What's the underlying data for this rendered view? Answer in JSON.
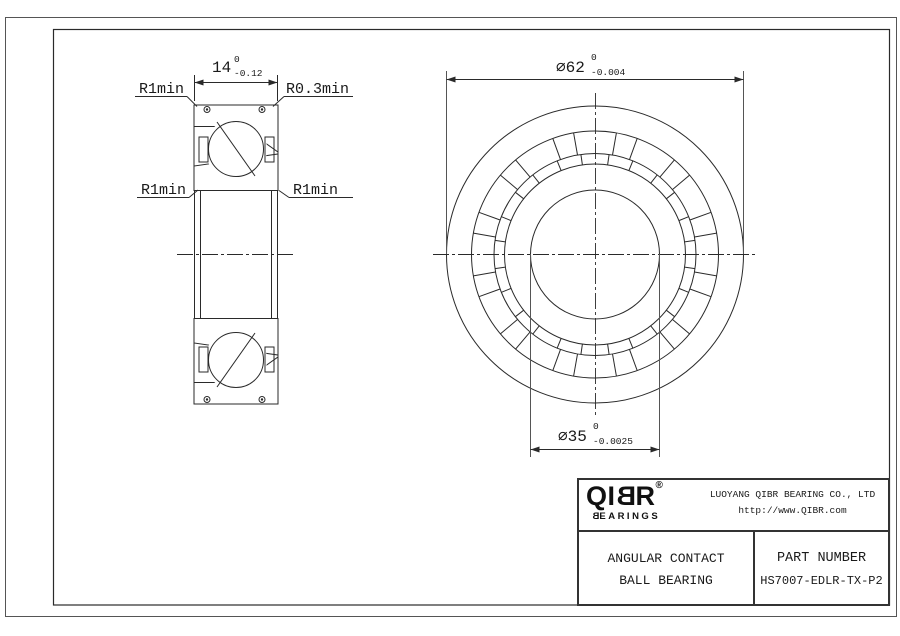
{
  "section_view": {
    "width_dim": {
      "value": "14",
      "tol_top": "0",
      "tol_bottom": "-0.12"
    },
    "label_top_left": "R1min",
    "label_top_right": "R0.3min",
    "label_mid_left": "R1min",
    "label_mid_right": "R1min"
  },
  "front_view": {
    "od_dim": {
      "value": "⌀62",
      "tol_top": "0",
      "tol_bottom": "-0.004"
    },
    "bore_dim": {
      "value": "⌀35",
      "tol_top": "0",
      "tol_bottom": "-0.0025"
    }
  },
  "title_block": {
    "brand": {
      "prefix": "QI",
      "mirrored_letter": "B",
      "suffix": "R",
      "registered": "®",
      "tagline_mirrored_letter": "B",
      "tagline_rest": "EARINGS"
    },
    "company_name": "LUOYANG QIBR BEARING CO., LTD",
    "website": "http://www.QIBR.com",
    "product_type_line1": "ANGULAR CONTACT",
    "product_type_line2": "BALL BEARING",
    "part_number_label": "PART NUMBER",
    "part_number": "HS7007-EDLR-TX-P2"
  }
}
